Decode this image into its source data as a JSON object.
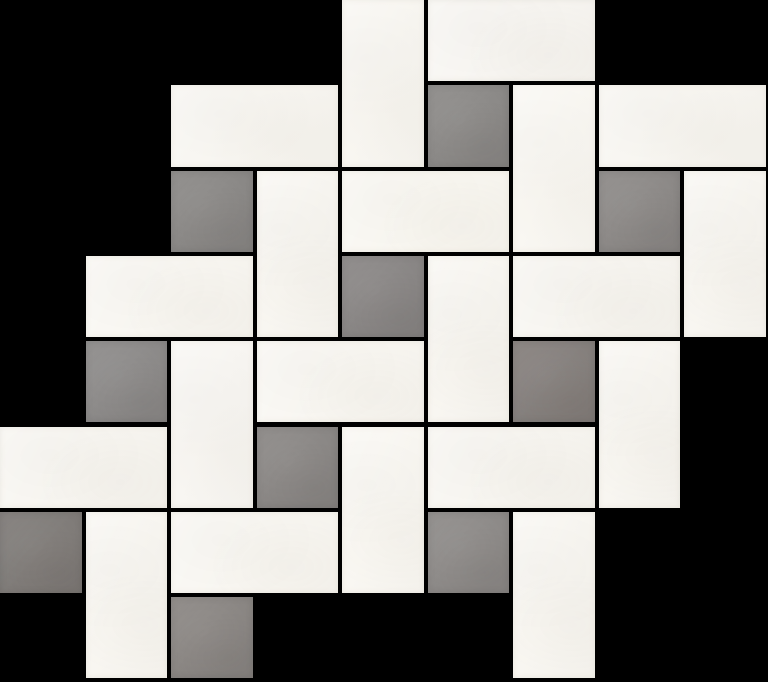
{
  "scene": {
    "kind": "mosaic-tile-product-photo",
    "pattern": "pinwheel-basketweave",
    "canvas": {
      "width": 768,
      "height": 682
    },
    "background_color": "#000000",
    "grout_color": "#000000",
    "colors": {
      "white_tile": "#f8f6f1",
      "gray_tile": "#8b8886"
    },
    "grid": {
      "cols": 9,
      "rows": 8,
      "unit_x": 85.5,
      "unit_y": 85.3,
      "grout": 4
    },
    "tiles": [
      {
        "col": 4,
        "row": 0,
        "w": 1,
        "h": 2,
        "color": "white",
        "shade": "#f8f6f1"
      },
      {
        "col": 5,
        "row": 0,
        "w": 2,
        "h": 1,
        "color": "white",
        "shade": "#f8f6f2"
      },
      {
        "col": 2,
        "row": 1,
        "w": 2,
        "h": 1,
        "color": "white",
        "shade": "#f8f6f1"
      },
      {
        "col": 5,
        "row": 1,
        "w": 1,
        "h": 1,
        "color": "gray",
        "shade": "#8b8987"
      },
      {
        "col": 6,
        "row": 1,
        "w": 1,
        "h": 2,
        "color": "white",
        "shade": "#f9f7f2"
      },
      {
        "col": 7,
        "row": 1,
        "w": 2,
        "h": 1,
        "color": "white",
        "shade": "#f8f6f1"
      },
      {
        "col": 2,
        "row": 2,
        "w": 1,
        "h": 1,
        "color": "gray",
        "shade": "#8a8886"
      },
      {
        "col": 3,
        "row": 2,
        "w": 1,
        "h": 2,
        "color": "white",
        "shade": "#f8f6f1"
      },
      {
        "col": 4,
        "row": 2,
        "w": 2,
        "h": 1,
        "color": "white",
        "shade": "#f9f7f1"
      },
      {
        "col": 7,
        "row": 2,
        "w": 1,
        "h": 1,
        "color": "gray",
        "shade": "#8c8987"
      },
      {
        "col": 8,
        "row": 2,
        "w": 1,
        "h": 2,
        "color": "white",
        "shade": "#f8f6f1"
      },
      {
        "col": 1,
        "row": 3,
        "w": 2,
        "h": 1,
        "color": "white",
        "shade": "#f9f7f2"
      },
      {
        "col": 4,
        "row": 3,
        "w": 1,
        "h": 1,
        "color": "gray",
        "shade": "#898685"
      },
      {
        "col": 5,
        "row": 3,
        "w": 1,
        "h": 2,
        "color": "white",
        "shade": "#f8f6f1"
      },
      {
        "col": 6,
        "row": 3,
        "w": 2,
        "h": 1,
        "color": "white",
        "shade": "#f8f6f1"
      },
      {
        "col": 1,
        "row": 4,
        "w": 1,
        "h": 1,
        "color": "gray",
        "shade": "#8c8a89"
      },
      {
        "col": 2,
        "row": 4,
        "w": 1,
        "h": 2,
        "color": "white",
        "shade": "#f8f6f2"
      },
      {
        "col": 3,
        "row": 4,
        "w": 2,
        "h": 1,
        "color": "white",
        "shade": "#f9f7f2"
      },
      {
        "col": 6,
        "row": 4,
        "w": 1,
        "h": 1,
        "color": "gray",
        "shade": "#857f7c"
      },
      {
        "col": 7,
        "row": 4,
        "w": 1,
        "h": 2,
        "color": "white",
        "shade": "#f8f6f1"
      },
      {
        "col": 0,
        "row": 5,
        "w": 2,
        "h": 1,
        "color": "white",
        "shade": "#f8f6f1"
      },
      {
        "col": 3,
        "row": 5,
        "w": 1,
        "h": 1,
        "color": "gray",
        "shade": "#8a8785"
      },
      {
        "col": 4,
        "row": 5,
        "w": 1,
        "h": 2,
        "color": "white",
        "shade": "#f9f7f2"
      },
      {
        "col": 5,
        "row": 5,
        "w": 2,
        "h": 1,
        "color": "white",
        "shade": "#f8f6f1"
      },
      {
        "col": 0,
        "row": 6,
        "w": 1,
        "h": 1,
        "color": "gray",
        "shade": "#7f7b78"
      },
      {
        "col": 1,
        "row": 6,
        "w": 1,
        "h": 2,
        "color": "white",
        "shade": "#f8f6f1"
      },
      {
        "col": 2,
        "row": 6,
        "w": 2,
        "h": 1,
        "color": "white",
        "shade": "#f9f7f2"
      },
      {
        "col": 5,
        "row": 6,
        "w": 1,
        "h": 1,
        "color": "gray",
        "shade": "#8d8a88"
      },
      {
        "col": 6,
        "row": 6,
        "w": 1,
        "h": 2,
        "color": "white",
        "shade": "#f8f6f1"
      },
      {
        "col": 2,
        "row": 7,
        "w": 1,
        "h": 1,
        "color": "gray",
        "shade": "#8a8683"
      }
    ]
  }
}
